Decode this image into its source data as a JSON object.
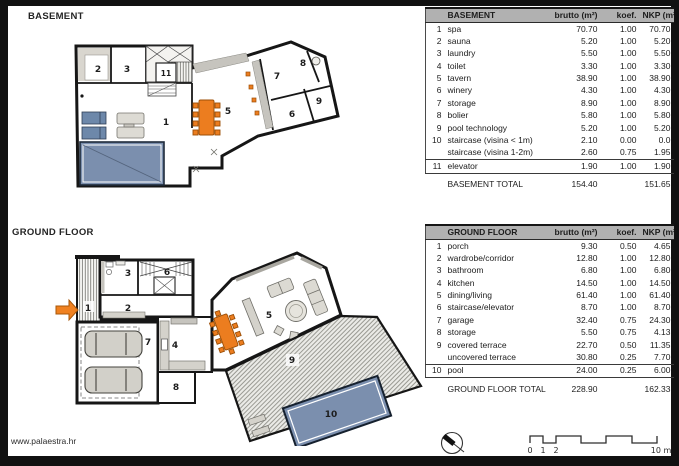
{
  "page": {
    "website": "www.palaestra.hr"
  },
  "plans": {
    "basement": {
      "title": "BASEMENT",
      "rooms": [
        "1",
        "2",
        "3",
        "5",
        "6",
        "7",
        "8",
        "9",
        "11"
      ]
    },
    "ground": {
      "title": "GROUND FLOOR",
      "rooms": [
        "1",
        "2",
        "3",
        "4",
        "5",
        "6",
        "7",
        "8",
        "9",
        "10"
      ]
    }
  },
  "tables": {
    "basement": {
      "headers": {
        "room": "BASEMENT",
        "brutto": "brutto (m²)",
        "koef": "koef.",
        "nkp": "NKP (m²)"
      },
      "rows": [
        [
          "1",
          "spa",
          "70.70",
          "1.00",
          "70.70"
        ],
        [
          "2",
          "sauna",
          "5.20",
          "1.00",
          "5.20"
        ],
        [
          "3",
          "laundry",
          "5.50",
          "1.00",
          "5.50"
        ],
        [
          "4",
          "toilet",
          "3.30",
          "1.00",
          "3.30"
        ],
        [
          "5",
          "tavern",
          "38.90",
          "1.00",
          "38.90"
        ],
        [
          "6",
          "winery",
          "4.30",
          "1.00",
          "4.30"
        ],
        [
          "7",
          "storage",
          "8.90",
          "1.00",
          "8.90"
        ],
        [
          "8",
          "bolier",
          "5.80",
          "1.00",
          "5.80"
        ],
        [
          "9",
          "pool technology",
          "5.20",
          "1.00",
          "5.20"
        ],
        [
          "10",
          "staircase (visina < 1m)",
          "2.10",
          "0.00",
          "0.0"
        ],
        [
          "",
          "staircase (visina 1-2m)",
          "2.60",
          "0.75",
          "1.95"
        ],
        [
          "11",
          "elevator",
          "1.90",
          "1.00",
          "1.90"
        ]
      ],
      "total": {
        "label": "BASEMENT TOTAL",
        "brutto": "154.40",
        "nkp": "151.65"
      }
    },
    "ground": {
      "headers": {
        "room": "GROUND FLOOR",
        "brutto": "brutto (m²)",
        "koef": "koef.",
        "nkp": "NKP (m²)"
      },
      "rows": [
        [
          "1",
          "porch",
          "9.30",
          "0.50",
          "4.65"
        ],
        [
          "2",
          "wardrobe/corridor",
          "12.80",
          "1.00",
          "12.80"
        ],
        [
          "3",
          "bathroom",
          "6.80",
          "1.00",
          "6.80"
        ],
        [
          "4",
          "kitchen",
          "14.50",
          "1.00",
          "14.50"
        ],
        [
          "5",
          "dining/living",
          "61.40",
          "1.00",
          "61.40"
        ],
        [
          "6",
          "staircase/elevator",
          "8.70",
          "1.00",
          "8.70"
        ],
        [
          "7",
          "garage",
          "32.40",
          "0.75",
          "24.30"
        ],
        [
          "8",
          "storage",
          "5.50",
          "0.75",
          "4.13"
        ],
        [
          "9",
          "covered terrace",
          "22.70",
          "0.50",
          "11.35"
        ],
        [
          "",
          "uncovered terrace",
          "30.80",
          "0.25",
          "7.70"
        ],
        [
          "10",
          "pool",
          "24.00",
          "0.25",
          "6.00"
        ]
      ],
      "total": {
        "label": "GROUND FLOOR TOTAL",
        "brutto": "228.90",
        "nkp": "162.33"
      }
    }
  },
  "legend": {
    "scale_labels": [
      "0",
      "1",
      "2",
      "10 m"
    ]
  },
  "colors": {
    "accent_orange": "#ec7d1f",
    "pool_blue": "#7b8fae",
    "header_gray": "#b1b1b1",
    "wall_black": "#161616"
  }
}
